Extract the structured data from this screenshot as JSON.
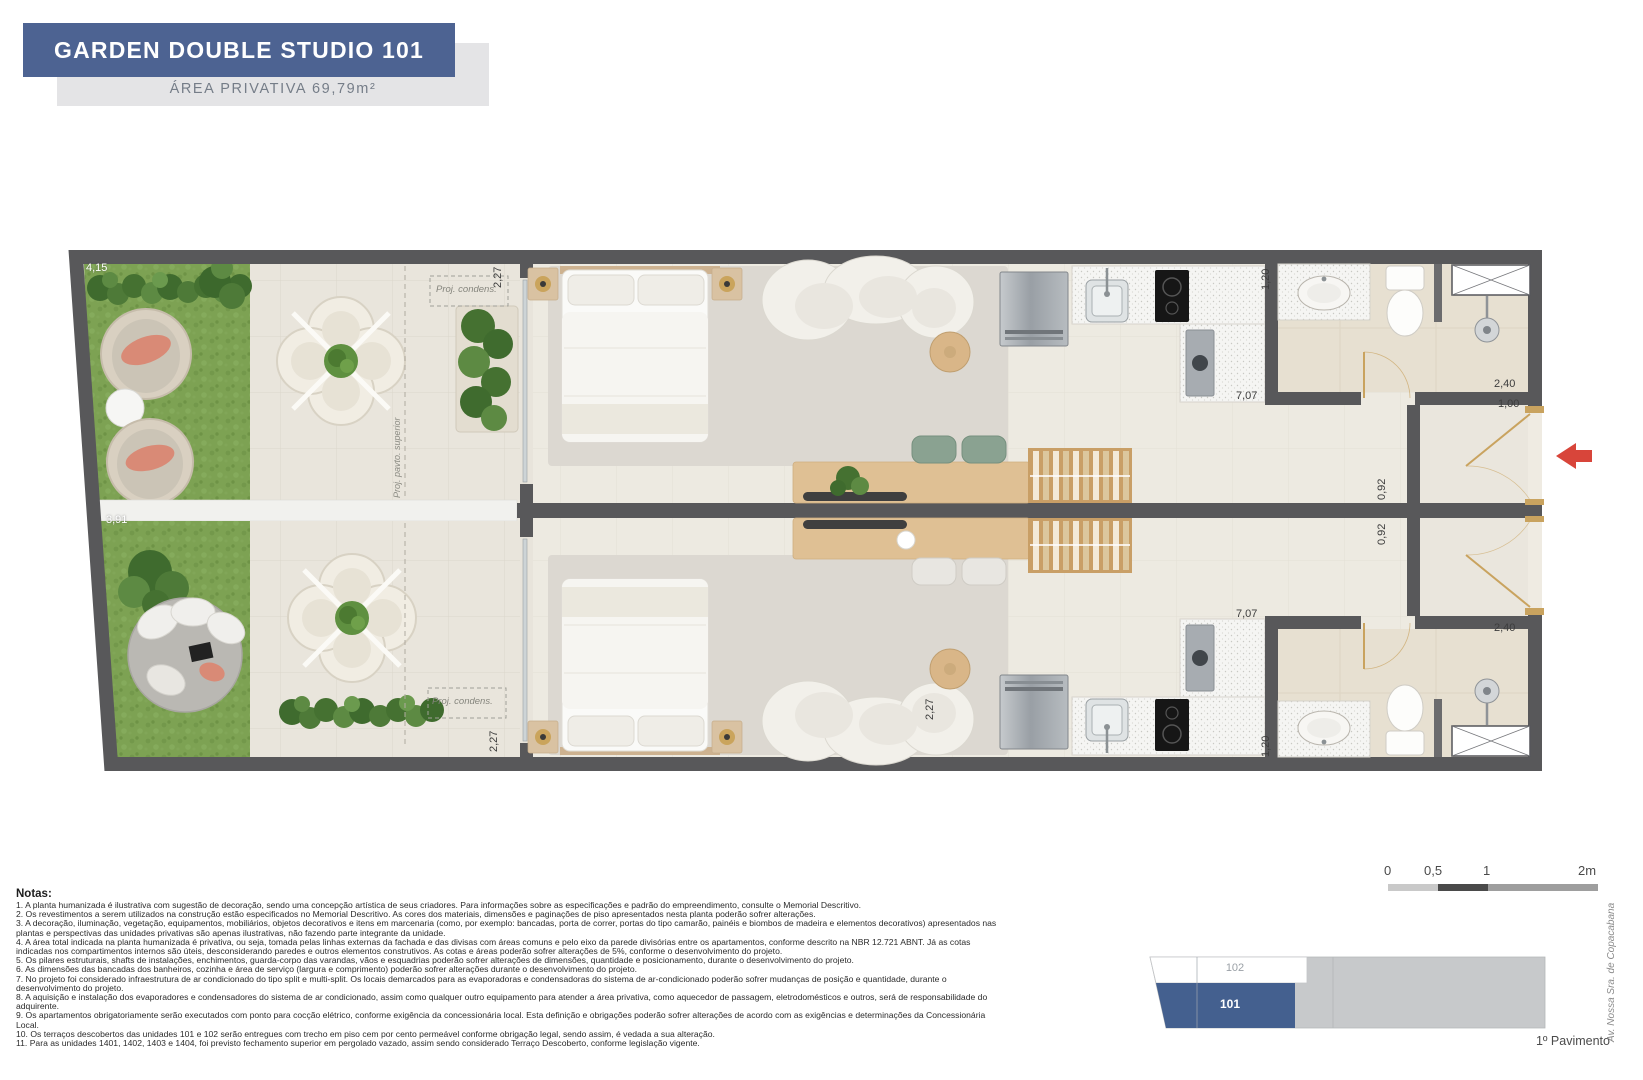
{
  "header": {
    "title": "GARDEN DOUBLE STUDIO 101",
    "area_label": "ÁREA PRIVATIVA 69,79m²"
  },
  "plan": {
    "dimensions": {
      "d415": "4,15",
      "d391": "3,91",
      "d227_top": "2,27",
      "d227_bottom1": "2,27",
      "d227_bottom2": "2,27",
      "d120_top": "1,20",
      "d120_bottom": "1,20",
      "d707_top": "7,07",
      "d707_bottom": "7,07",
      "d240_top": "2,40",
      "d240_bottom": "2,40",
      "d100": "1,00",
      "d092_top": "0,92",
      "d092_bottom": "0,92"
    },
    "labels": {
      "proj_condens": "Proj. condens.",
      "proj_pavto": "Proj. pavto. superior"
    }
  },
  "scale_bar": {
    "t0": "0",
    "t05": "0,5",
    "t1": "1",
    "t2": "2m"
  },
  "key_plan": {
    "unit_102": "102",
    "unit_101": "101",
    "floor_label": "1º Pavimento"
  },
  "street_label": "Av. Nossa Sra. de Copacabana",
  "notes": {
    "title": "Notas:",
    "items": [
      "1. A planta humanizada é ilustrativa com sugestão de decoração, sendo uma concepção artística de seus criadores. Para informações sobre as especificações e padrão do empreendimento, consulte o Memorial Descritivo.",
      "2. Os revestimentos a serem utilizados na construção estão especificados no Memorial Descritivo. As cores dos materiais, dimensões e paginações de piso apresentados nesta planta poderão sofrer alterações.",
      "3. A decoração, iluminação, vegetação, equipamentos, mobiliários, objetos decorativos e itens em marcenaria (como, por exemplo: bancadas, porta de correr, portas do tipo camarão, painéis e biombos de madeira e elementos decorativos) apresentados nas plantas e perspectivas das unidades privativas são apenas ilustrativas, não fazendo parte integrante da unidade.",
      "4. A área total indicada na planta humanizada é privativa, ou seja, tomada pelas linhas externas da fachada e das divisas com áreas comuns e pelo eixo da parede divisórias entre os apartamentos, conforme descrito na NBR 12.721 ABNT. Já as cotas indicadas nos compartimentos internos são úteis, desconsiderando paredes e outros elementos construtivos. As cotas e áreas poderão sofrer alterações de 5%, conforme o desenvolvimento do projeto.",
      "5. Os pilares estruturais, shafts de instalações, enchimentos, guarda-corpo das varandas, vãos e esquadrias poderão sofrer alterações de dimensões, quantidade e posicionamento, durante o desenvolvimento do projeto.",
      "6. As dimensões das bancadas dos banheiros, cozinha e área de serviço (largura e comprimento) poderão sofrer alterações durante o desenvolvimento do projeto.",
      "7. No projeto foi considerado infraestrutura de ar condicionado do tipo split e multi-split. Os locais demarcados para as evaporadoras e condensadoras do sistema de ar-condicionado poderão sofrer mudanças de posição e quantidade, durante o desenvolvimento do projeto.",
      "8. A aquisição e instalação dos evaporadores e condensadores do sistema de ar condicionado, assim como qualquer outro equipamento para atender a área privativa, como aquecedor de passagem, eletrodomésticos e outros, será de responsabilidade do adquirente.",
      "9. Os apartamentos obrigatoriamente serão executados com ponto para cocção elétrico, conforme exigência da concessionária local. Esta definição e obrigações poderão sofrer alterações de acordo com as exigências e determinações da Concessionária Local.",
      "10. Os terraços descobertos das unidades 101 e 102 serão entregues com trecho em piso cem por cento permeável conforme obrigação legal, sendo assim, é vedada a sua alteração.",
      "11. Para as unidades 1401, 1402, 1403 e 1404, foi previsto fechamento superior em pergolado vazado, assim sendo considerado Terraço Descoberto, conforme legislação vigente."
    ]
  },
  "colors": {
    "accent_blue": "#4d6392",
    "keyplan_blue": "#44608f",
    "arrow_red": "#d8453a",
    "wall_gray": "#58585a"
  }
}
